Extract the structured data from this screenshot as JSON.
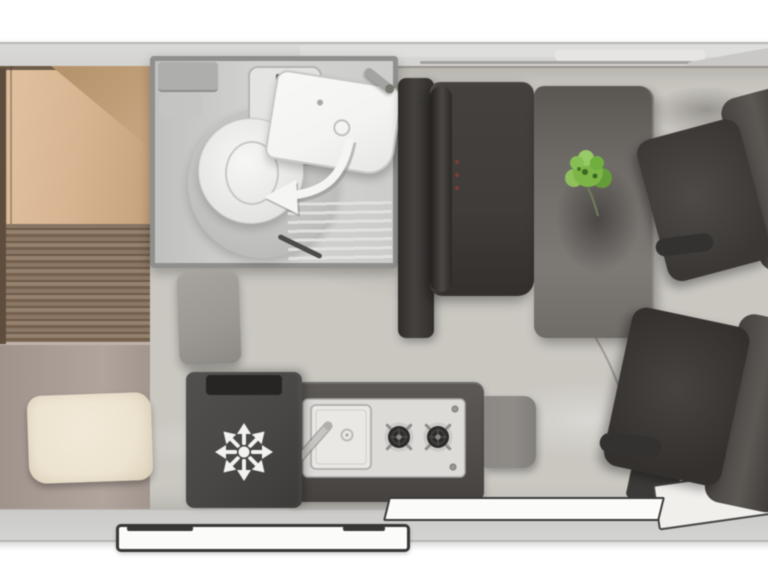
{
  "scene": {
    "description": "Top-down floor plan of a campervan interior, cab on the right",
    "areas": {
      "bed": "rear longitudinal bed with duvet and pillow",
      "bathroom": "wet room with swivel toilet, fold-away washbasin and shower",
      "wardrobe": "tall dark cabinet",
      "bench": "dinette bench seat",
      "table": "dining table with plant",
      "kitchen": "kitchenette with sink and two-burner hob",
      "fridge": "compressor fridge",
      "stool": "upholstered stool cushion",
      "seat_front_top": "swivelled cab seat facing table",
      "seat_front_bottom": "swivelled cab seat near sliding door",
      "entry": "sliding door entry sill",
      "rail": "sliding door outer rail",
      "swing": "door swing arc on floor"
    }
  },
  "icons": {
    "fridge": "snowflake-icon",
    "bathroom_arrow": "swivel-arrow-icon",
    "plant": "plant-icon"
  },
  "palette": {
    "shell": "#d0cfcd",
    "shell-edge": "#b7b6b4",
    "floor": "#cac7c1",
    "bath-floor": "#d3d3d1",
    "bath-wall": "#8f8f8d",
    "fixture": "#f4f4f2",
    "duvet": "#d8b592",
    "duvet-dark": "#a8875f",
    "wood": "#7c6956",
    "sofa": "#a89b94",
    "pillow": "#ece3d0",
    "dark-unit": "#332f2d",
    "bench": "#403c3a",
    "table": "#6e6a66",
    "plant": "#7cb448",
    "plant-dark": "#3c671f",
    "seat": "#4e4a47",
    "seat-dark": "#363330",
    "fridge": "#484746",
    "counter": "#514e4b",
    "panel": "#dcdbd8",
    "burner": "#2c2b2a",
    "flap": "#8f8c88",
    "arc": "#97948f",
    "frame": "#3a3a38",
    "trim-white": "#fbfbfa",
    "stool": "#9c9995"
  }
}
